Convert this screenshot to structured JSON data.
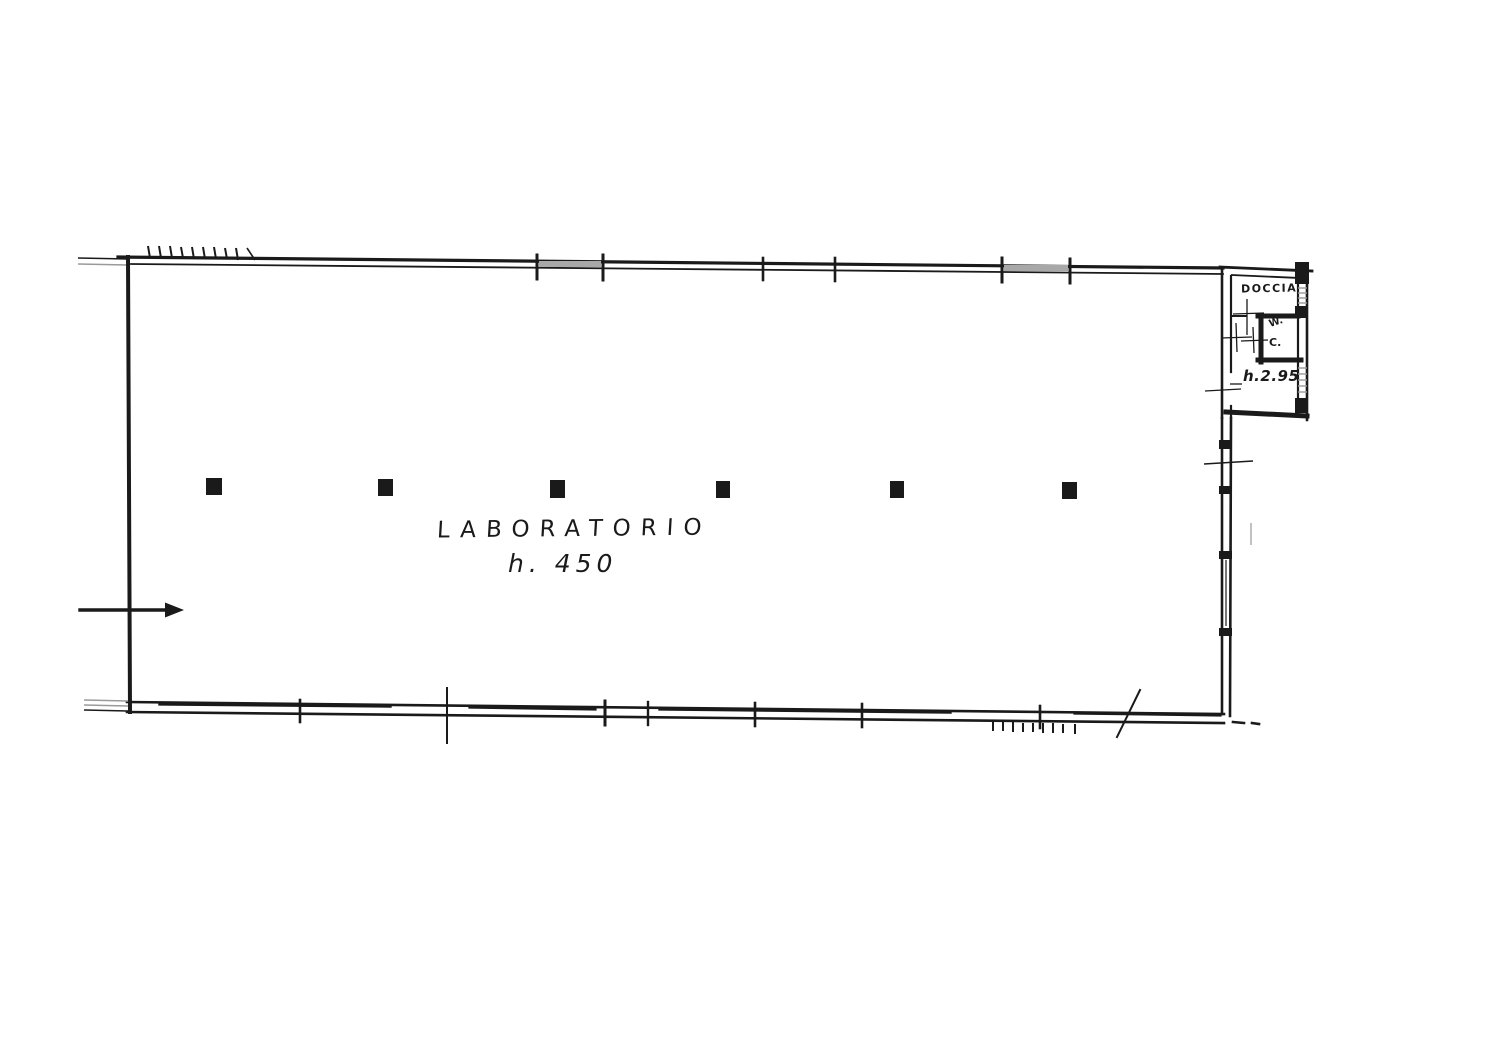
{
  "plan": {
    "main_room": {
      "label": "LABORATORIO",
      "height_label": "h. 450"
    },
    "bathroom": {
      "shower_label": "DOCCIA",
      "wc_label_line1": "W.",
      "wc_label_line2": "C.",
      "height_label": "h.2.95"
    },
    "colors": {
      "ink": "#1a1a1a",
      "paper": "#ffffff",
      "window_gray": "#9a9a9a"
    }
  }
}
